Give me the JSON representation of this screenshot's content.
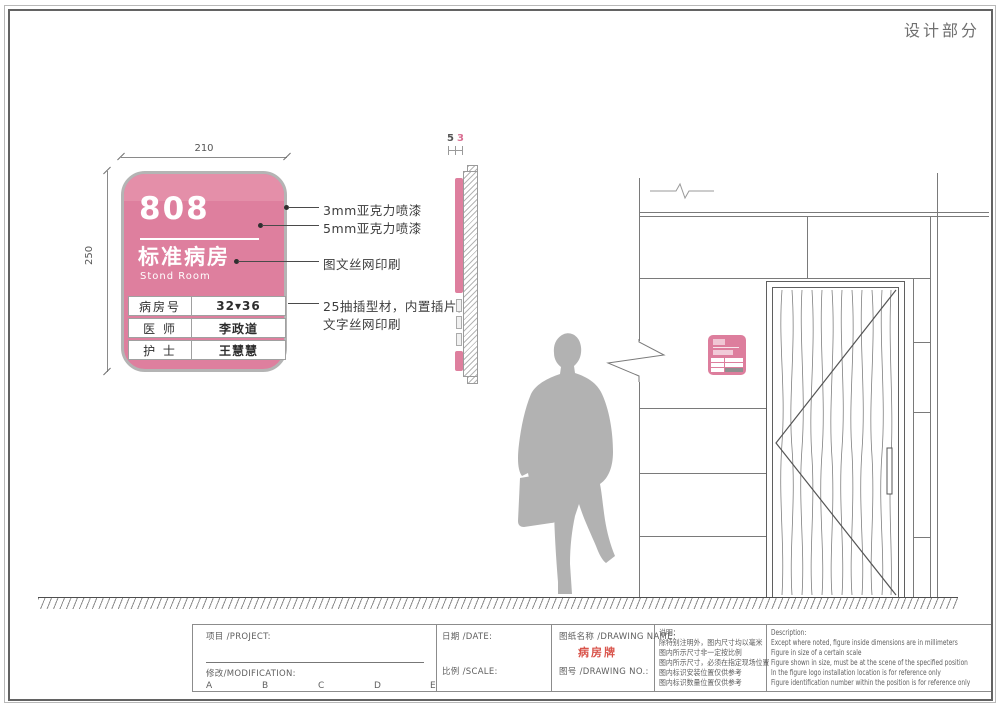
{
  "page": {
    "corner_title": "设计部分"
  },
  "front_view": {
    "dim_width": "210",
    "dim_height": "250",
    "sign": {
      "room_number": "808",
      "title_cn": "标准病房",
      "title_en": "Stond Room",
      "table": {
        "rows": [
          {
            "label": "病房号",
            "value": "32▾36"
          },
          {
            "label": "医 师",
            "value": "李政道"
          },
          {
            "label": "护 士",
            "value": "王慧慧"
          }
        ]
      }
    },
    "annotations": [
      {
        "text": "3mm亚克力喷漆"
      },
      {
        "text": "5mm亚克力喷漆"
      },
      {
        "text": "图文丝网印刷"
      },
      {
        "text": "25抽插型材，内置插片，",
        "text2": "文字丝网印刷"
      }
    ]
  },
  "side_view": {
    "dim_a": "5",
    "dim_b": "3"
  },
  "title_block": {
    "project_label": "项目 /PROJECT:",
    "modification_label": "修改/MODIFICATION:",
    "revision_marks": [
      "A",
      "B",
      "C",
      "D",
      "E"
    ],
    "date_label": "日期 /DATE:",
    "scale_label": "比例 /SCALE:",
    "drawing_name_label": "图纸名称 /DRAWING NAME:",
    "drawing_name_value": "病房牌",
    "drawing_no_label": "图号 /DRAWING NO.:",
    "notes_cn": {
      "title": "说明：",
      "lines": [
        "除特别注明外，图内尺寸均以毫米",
        "图内所示尺寸非一定按比例",
        "图内所示尺寸，必须在指定现场位置",
        "图内标识安装位置仅供参考",
        "图内标识数量位置仅供参考"
      ]
    },
    "notes_en": {
      "title": "Description:",
      "lines": [
        "Except where noted, figure inside dimensions are in millimeters",
        "Figure in size of a certain scale",
        "Figure shown in size, must be at the scene of the specified position",
        "In the figure logo installation location is for reference only",
        "Figure identification number within the position is for reference only"
      ]
    }
  },
  "colors": {
    "sign_pink": "#de7f9e",
    "sign_pink_light": "#e48fa9",
    "sign_border_gray": "#b4b4b4",
    "drawing_name_red": "#d9544b",
    "line_gray": "#7a7a7a",
    "silhouette_gray": "#b2b2b2"
  }
}
